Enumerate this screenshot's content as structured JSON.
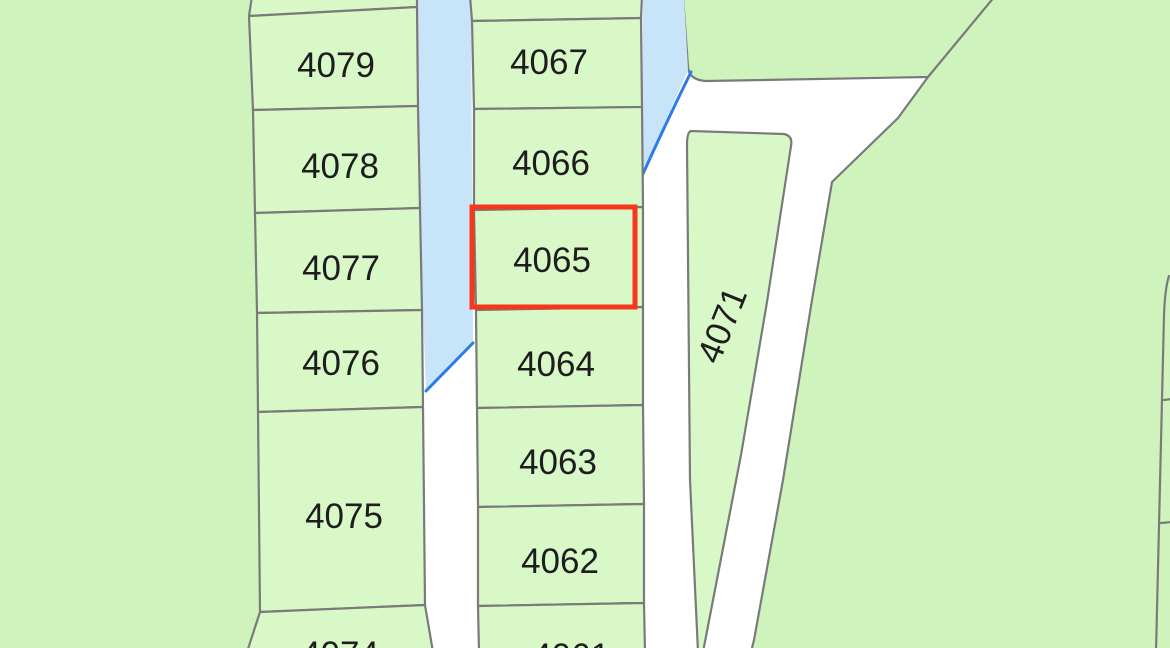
{
  "map": {
    "type": "cadastral-parcel-map",
    "selected_parcel": "4065",
    "colors": {
      "parcel_fill": "#d9f8c8",
      "area_fill": "#cef3bc",
      "water_fill": "#c8e4f8",
      "boundary_line": "#7a7a7a",
      "water_line": "#2e7be8",
      "highlight": "#f5371c",
      "label_text": "#1d1d1d",
      "road_fill": "#ffffff"
    },
    "parcels": [
      {
        "label": "4079"
      },
      {
        "label": "4078"
      },
      {
        "label": "4077"
      },
      {
        "label": "4076"
      },
      {
        "label": "4075"
      },
      {
        "label": "4074"
      },
      {
        "label": "4067"
      },
      {
        "label": "4066"
      },
      {
        "label": "4065"
      },
      {
        "label": "4064"
      },
      {
        "label": "4063"
      },
      {
        "label": "4062"
      },
      {
        "label": "4061"
      },
      {
        "label": "4071"
      }
    ]
  }
}
